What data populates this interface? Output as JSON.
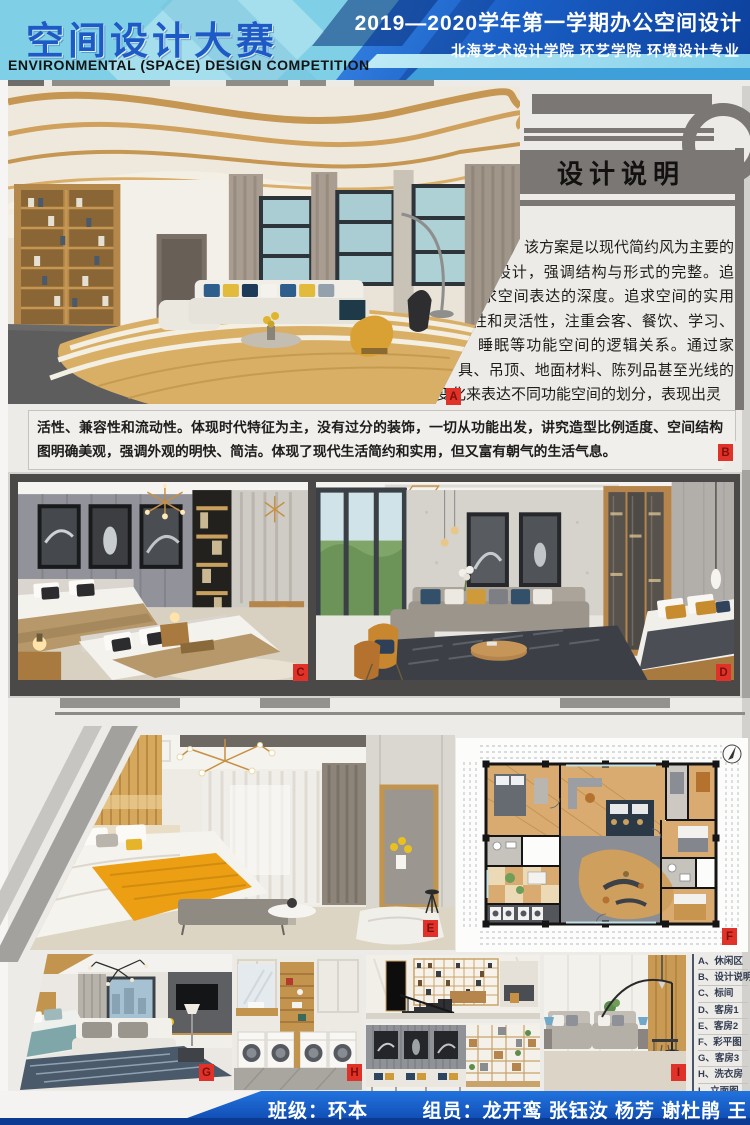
{
  "header": {
    "title_cn": "空间设计大赛",
    "title_en": "ENVIRONMENTAL (SPACE) DESIGN  COMPETITION",
    "term_line": "2019—2020学年第一学期办公空间设计",
    "school_line": "北海艺术设计学院 环艺学院 环境设计专业"
  },
  "design_note": {
    "title": "设计说明",
    "body_part1": "该方案是以现代简约风为主要的设计，强调结构与形式的完整。追求空间表达的深度。追求空间的实用性和灵活性，注重会客、餐饮、学习、睡眠等功能空间的逻辑关系。通过家具、吊顶、地面材料、陈列品甚至光线的变化来表达不同功能空间的划分，表现出灵",
    "body_part2": "活性、兼容性和流动性。体现时代特征为主，没有过分的装饰，一切从功能出发，讲究造型比例适度、空间结构图明确美观，强调外观的明快、简洁。体现了现代生活简约和实用，但又富有朝气的生活气息。"
  },
  "photo_labels": {
    "a": "A",
    "b": "B",
    "c": "C",
    "d": "D",
    "e": "E",
    "f": "F",
    "g": "G",
    "h": "H",
    "i": "I"
  },
  "legend": {
    "items": [
      "A、休闲区",
      "B、设计说明",
      "C、标间",
      "D、客房1",
      "E、客房2",
      "F、彩平图",
      "G、客房3",
      "H、洗衣房",
      "I、立面图"
    ]
  },
  "footer": {
    "class_line": "班级：环本1719",
    "members_line": "组员：龙开鸾 张钰汝 杨芳 谢杜鹃 王雨欣"
  },
  "colors": {
    "header_left_bg": "#7fd0e6",
    "title_blue": "#1d5ac6",
    "header_right_blue": "#0c3f9a",
    "label_red": "#e03228",
    "panel_gray": "#7b7774",
    "gallery_dark": "#4b4947",
    "footer_blue": "#1566d2",
    "footer_navy": "#0a3a92",
    "board_bg": "#edebe7"
  }
}
